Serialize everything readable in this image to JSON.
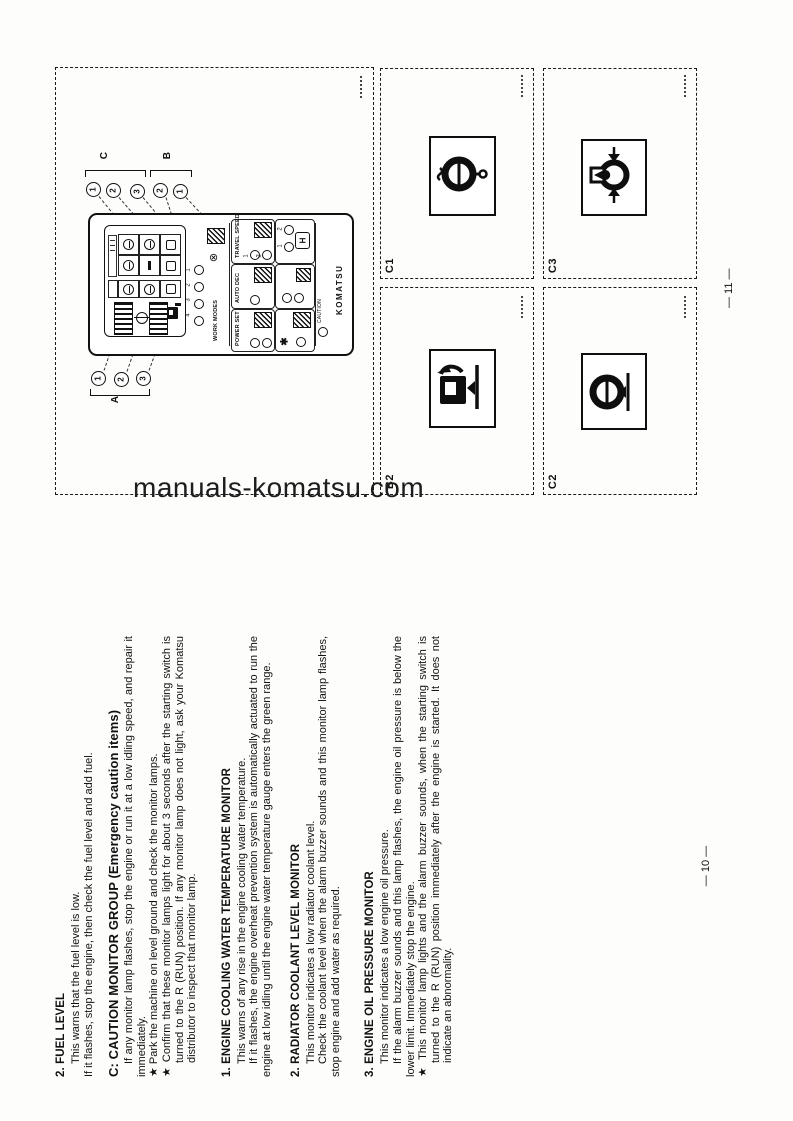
{
  "watermark": "manuals-komatsu.com",
  "left_page": {
    "page_number": "— 10 —",
    "sections": [
      {
        "title": "2. FUEL LEVEL",
        "paragraphs": [
          "This warns that the fuel level is low.",
          "If it flashes, stop the engine, then check the fuel level and add fuel."
        ]
      },
      {
        "title": "C: CAUTION MONITOR GROUP (Emergency caution items)",
        "paragraphs": [
          "If any monitor lamp flashes, stop the engine or run it at a low idling speed, and repair it immediately.",
          "★ Park the machine on level ground and check the monitor lamps.",
          "★ Confirm that these monitor lamps light for about 3 seconds after the starting switch is turned to the R (RUN) position. If any monitor lamp does not light, ask your Komatsu distributor to inspect that monitor lamp."
        ]
      },
      {
        "title": "1. ENGINE COOLING WATER TEMPERATURE MONITOR",
        "paragraphs": [
          "This warns of any rise in the engine cooling water temperature.",
          "If it flashes, the engine overheat prevention system is automatically actuated to run the engine at low idling until the engine water temperature gauge enters the green range."
        ]
      },
      {
        "title": "2. RADIATOR COOLANT LEVEL MONITOR",
        "paragraphs": [
          "This monitor indicates a low radiator coolant level.",
          "Check the coolant level when the alarm buzzer sounds and this monitor lamp flashes, stop engine and add water as required."
        ]
      },
      {
        "title": "3. ENGINE OIL PRESSURE MONITOR",
        "paragraphs": [
          "This monitor indicates a low engine oil pressure.",
          "If the alarm buzzer sounds and this lamp flashes, the engine oil pressure is below the lower limit. Immediately stop the engine.",
          "★ This monitor lamp lights and the alarm buzzer sounds, when the starting switch is turned to the R (RUN) position immediately after the engine is started. It does not indicate an abnormality."
        ]
      }
    ]
  },
  "right_page": {
    "page_number": "— 11 —",
    "figure": {
      "group_labels": {
        "c": "C",
        "b": "B",
        "a": "A"
      },
      "callouts_top": [
        "1",
        "2",
        "3",
        "2",
        "1"
      ],
      "callouts_bottom": [
        "1",
        "2",
        "3"
      ],
      "panel": {
        "work_modes": "WORK MODES",
        "travel_speed": "TRAVEL SPEED",
        "auto_dec": "AUTO DEC",
        "power_set": "POWER SET",
        "brand": "KOMATSU",
        "caution": "CAUTION",
        "buzzer_glyph": "⊗",
        "snow_glyph": "✱",
        "h_button": "H",
        "mode_digits": [
          "1",
          "2",
          "3",
          "4"
        ],
        "travel_digits": [
          "1",
          "2"
        ],
        "h_digits": [
          "2",
          "1"
        ]
      }
    },
    "icon_panels": [
      {
        "label": "C1",
        "icon": "water-temperature-icon"
      },
      {
        "label": "C3",
        "icon": "radiator-coolant-level-icon"
      },
      {
        "label": "B2",
        "icon": "fuel-level-icon"
      },
      {
        "label": "C2",
        "icon": "engine-oil-pressure-icon"
      }
    ]
  }
}
